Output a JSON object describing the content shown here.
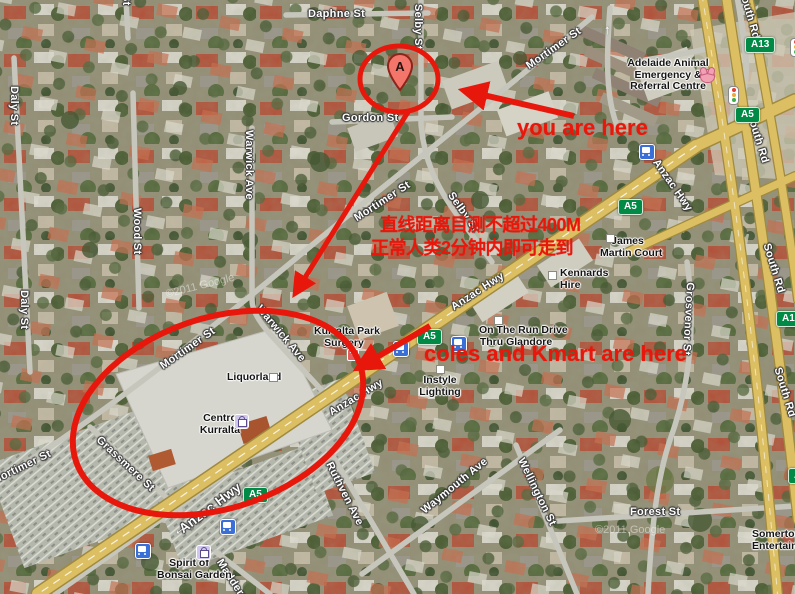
{
  "annotations": {
    "you_are_here": "you are here",
    "distance_line1": "直线距离目测不超过400M",
    "distance_line2": "正常人类2分钟内即可走到",
    "coles_kmart": "coles and Kmart are here",
    "marker_letter": "A",
    "color": "#e8170c"
  },
  "streets": {
    "daphne": "Daphne St",
    "selby": "Selby St",
    "gordon": "Gordon St",
    "mortimer": "Mortimer St",
    "daly": "Daly St",
    "wood": "Wood St",
    "warwick": "Warwick Ave",
    "grassmere": "Grassmere St",
    "anzac": "Anzac Hwy",
    "south_rd": "South Rd",
    "grosvenor": "Grosvenor St",
    "forest": "Forest St",
    "ruthven": "Ruthven Ave",
    "waymouth": "Waymouth Ave",
    "wellington": "Wellington St",
    "maddern": "Maddern St",
    "st_fragment": "St"
  },
  "shields": {
    "a5": "A5",
    "a13": "A13"
  },
  "pois": {
    "animal_hospital": {
      "line1": "Adelaide Animal",
      "line2": "Emergency &",
      "line3": "Referral Centre"
    },
    "james_martin": {
      "line1": "James",
      "line2": "Martin Court"
    },
    "kennards": {
      "line1": "Kennards",
      "line2": "Hire"
    },
    "otr": {
      "line1": "On The Run Drive",
      "line2": "Thru Glandore"
    },
    "instyle": {
      "line1": "Instyle",
      "line2": "Lighting"
    },
    "surgery": {
      "line1": "Kurralta Park",
      "line2": "Surgery"
    },
    "liquorland": "Liquorland",
    "centro": {
      "line1": "Centro",
      "line2": "Kurralta"
    },
    "bonsai": {
      "line1": "Spirit of",
      "line2": "Bonsai Garden"
    },
    "somerton": {
      "line1": "Somerton",
      "line2": "Entertainment"
    }
  },
  "watermark": "©2011 Google",
  "colors": {
    "annotation_red": "#e8170c",
    "shield_green": "#008a45",
    "highway_yellow": "#dcbf63",
    "minor_road_gray": "#c6c6bc",
    "bus_icon_blue": "#3a6fd8"
  }
}
